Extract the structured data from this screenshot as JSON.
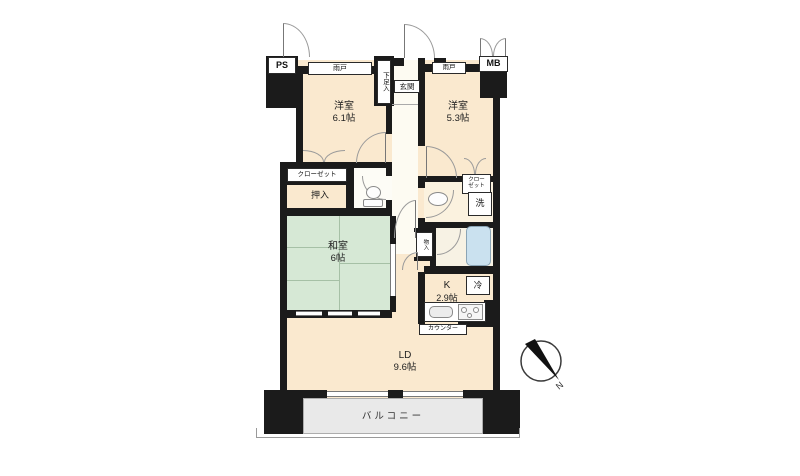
{
  "plan": {
    "ps": "PS",
    "mb": "MB",
    "amado": "雨戸",
    "shoe_box": "下足入",
    "entrance": "玄関",
    "bedroom1": {
      "name": "洋室",
      "size": "6.1帖"
    },
    "bedroom2": {
      "name": "洋室",
      "size": "5.3帖"
    },
    "closet1": "クローゼット",
    "closet2_line1": "クロー",
    "closet2_line2": "ゼット",
    "oshiire": "押入",
    "washitsu": {
      "name": "和室",
      "size": "6帖"
    },
    "laundry": "洗",
    "storage": "物入",
    "fridge": "冷",
    "kitchen": {
      "name": "K",
      "size": "2.9帖"
    },
    "counter": "カウンター",
    "ld": {
      "name": "LD",
      "size": "9.6帖"
    },
    "balcony": "バルコニー",
    "compass_north": "N"
  },
  "colors": {
    "wall": "#1b1b1b",
    "room": "#fae9cf",
    "tatami": "#d6e8d5",
    "tub": "#cae1ef",
    "balcony": "#e9e9e9"
  }
}
